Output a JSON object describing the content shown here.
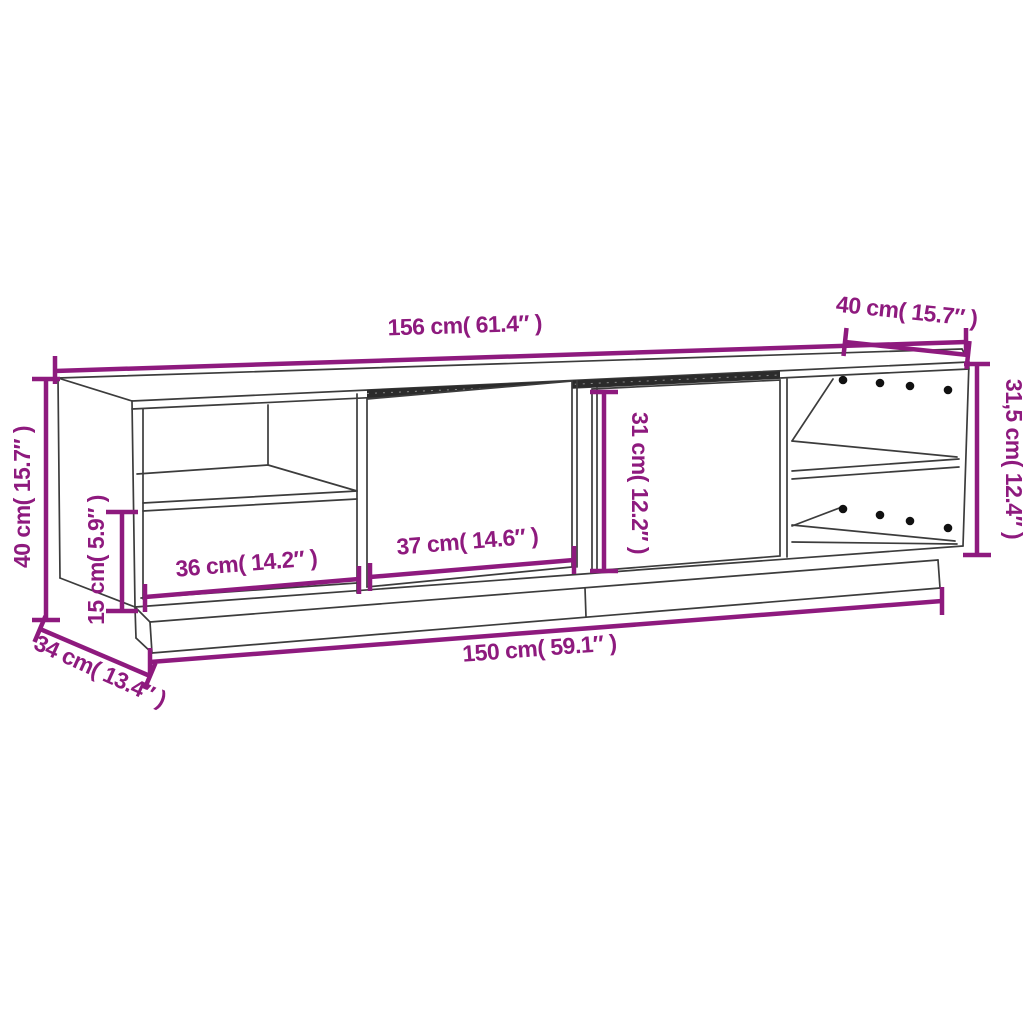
{
  "colors": {
    "accent": "#8e1a7e",
    "outline": "#3c3c3c",
    "band": "#2b2b2b",
    "dot": "#111111",
    "background": "#ffffff"
  },
  "diagram": {
    "type": "furniture-dimension-drawing",
    "subject": "tv-cabinet-with-doors-and-shelves"
  },
  "labels": {
    "top_width": "156 cm( 61.4″ )",
    "top_depth": "40 cm( 15.7″ )",
    "right_height": "31,5 cm( 12.4″ )",
    "left_height": "40 cm( 15.7″ )",
    "plinth_height": "15 cm( 5.9″ )",
    "shelf_width": "36 cm( 14.2″ )",
    "door_width": "37 cm( 14.6″ )",
    "door_height": "31 cm( 12.2″ )",
    "bottom_width": "150 cm( 59.1″ )",
    "side_depth": "34 cm( 13.4″ )"
  }
}
